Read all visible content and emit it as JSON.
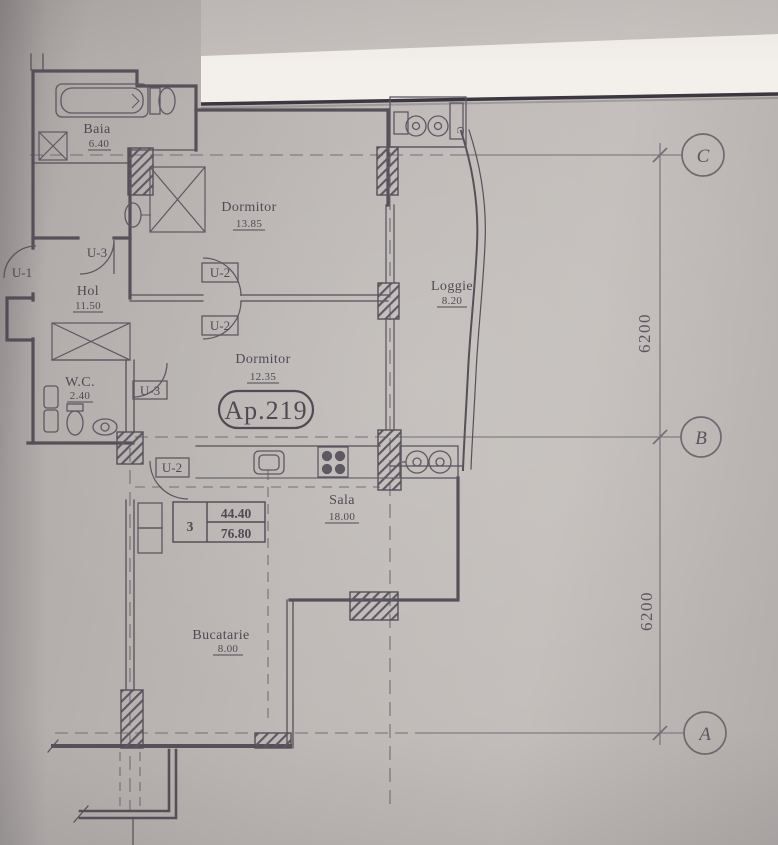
{
  "plan": {
    "apartment": "Ap.219",
    "rooms": {
      "baia": {
        "name": "Baia",
        "area": "6.40"
      },
      "dormitor1": {
        "name": "Dormitor",
        "area": "13.85"
      },
      "hol": {
        "name": "Hol",
        "area": "11.50"
      },
      "wc": {
        "name": "W.C.",
        "area": "2.40"
      },
      "dormitor2": {
        "name": "Dormitor",
        "area": "12.35"
      },
      "loggie": {
        "name": "Loggie",
        "area": "8.20"
      },
      "sala": {
        "name": "Sala",
        "area": "18.00"
      },
      "bucatarie": {
        "name": "Bucatarie",
        "area": "8.00"
      }
    },
    "door_tags": {
      "u1_entry": "U-1",
      "u3_hol": "U-3",
      "u2_dorm_upper": "U-2",
      "u2_dorm_lower": "U-2",
      "u3_wc": "U-3",
      "u2_kitchen": "U-2"
    },
    "summary_table": {
      "rooms": "3",
      "area_living": "44.40",
      "area_total": "76.80"
    },
    "grid": {
      "row_c": "C",
      "row_b": "B",
      "row_a": "A",
      "dim_cb": "6200",
      "dim_ba": "6200"
    },
    "fixture_label_c": "C"
  },
  "colors": {
    "paper": "#beb9b6",
    "ink": "#4f4a54",
    "white_sheet": "#f3f0ec",
    "sheet_edge": "#3a3740"
  }
}
